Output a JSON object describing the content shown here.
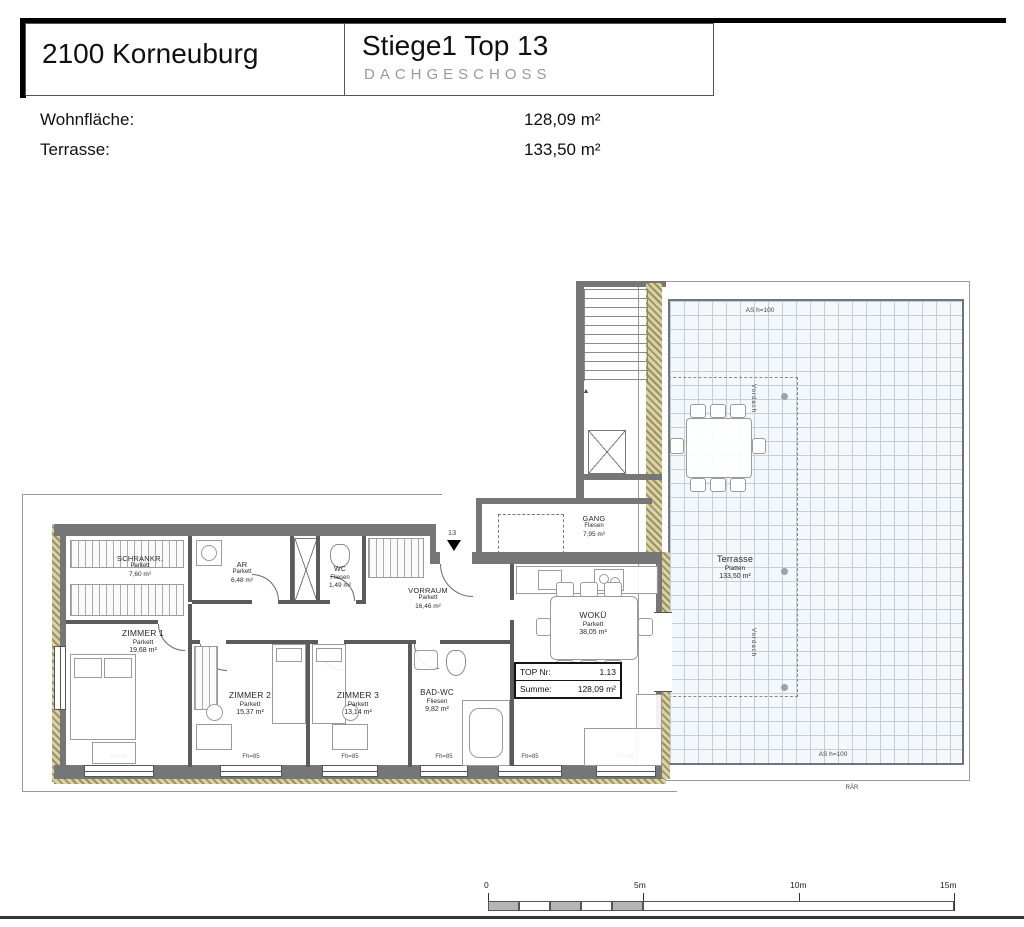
{
  "header": {
    "address": "2100 Korneuburg",
    "unit": "Stiege1 Top 13",
    "level": "DACHGESCHOSS"
  },
  "summary": {
    "rows": [
      {
        "label": "Wohnfläche:",
        "value": "128,09 m²"
      },
      {
        "label": "Terrasse:",
        "value": "133,50 m²"
      }
    ]
  },
  "rooms": {
    "schrankr": {
      "name": "SCHRANKR.",
      "floor": "Parkett",
      "area": "7,60 m²"
    },
    "ar": {
      "name": "AR",
      "floor": "Parkett",
      "area": "6,48 m²"
    },
    "wc": {
      "name": "WC",
      "floor": "Fliesen",
      "area": "1,49 m²"
    },
    "zimmer1": {
      "name": "ZIMMER 1",
      "floor": "Parkett",
      "area": "19,68 m²"
    },
    "zimmer2": {
      "name": "ZIMMER 2",
      "floor": "Parkett",
      "area": "15,37 m²"
    },
    "zimmer3": {
      "name": "ZIMMER 3",
      "floor": "Parkett",
      "area": "13,14 m²"
    },
    "badwc": {
      "name": "BAD-WC",
      "floor": "Fliesen",
      "area": "9,82 m²"
    },
    "vorraum": {
      "name": "VORRAUM",
      "floor": "Parkett",
      "area": "16,46 m²"
    },
    "woku": {
      "name": "WOKÜ",
      "floor": "Parkett",
      "area": "38,05 m²"
    },
    "gang": {
      "name": "GANG",
      "floor": "Fliesen",
      "area": "7,95 m²"
    },
    "terrasse": {
      "name": "Terrasse",
      "floor": "Platten",
      "area": "133,50 m²"
    }
  },
  "top_box": {
    "nr_label": "TOP Nr:",
    "nr_value": "1.13",
    "sum_label": "Summe:",
    "sum_value": "128,09 m²"
  },
  "annotations": {
    "entrance_no": "13",
    "as_top": "AS h=100",
    "as_bottom": "AS h=100",
    "raer": "RÄR",
    "fh": "Fh=85",
    "vordach": "Vordach"
  },
  "scalebar": {
    "t0": "0",
    "t5": "5m",
    "t10": "10m",
    "t15": "15m"
  },
  "colors": {
    "wall_gray": "#767676",
    "insulation_olive": "#d9d2a7",
    "terrace_grid_line": "#c4ced6"
  }
}
